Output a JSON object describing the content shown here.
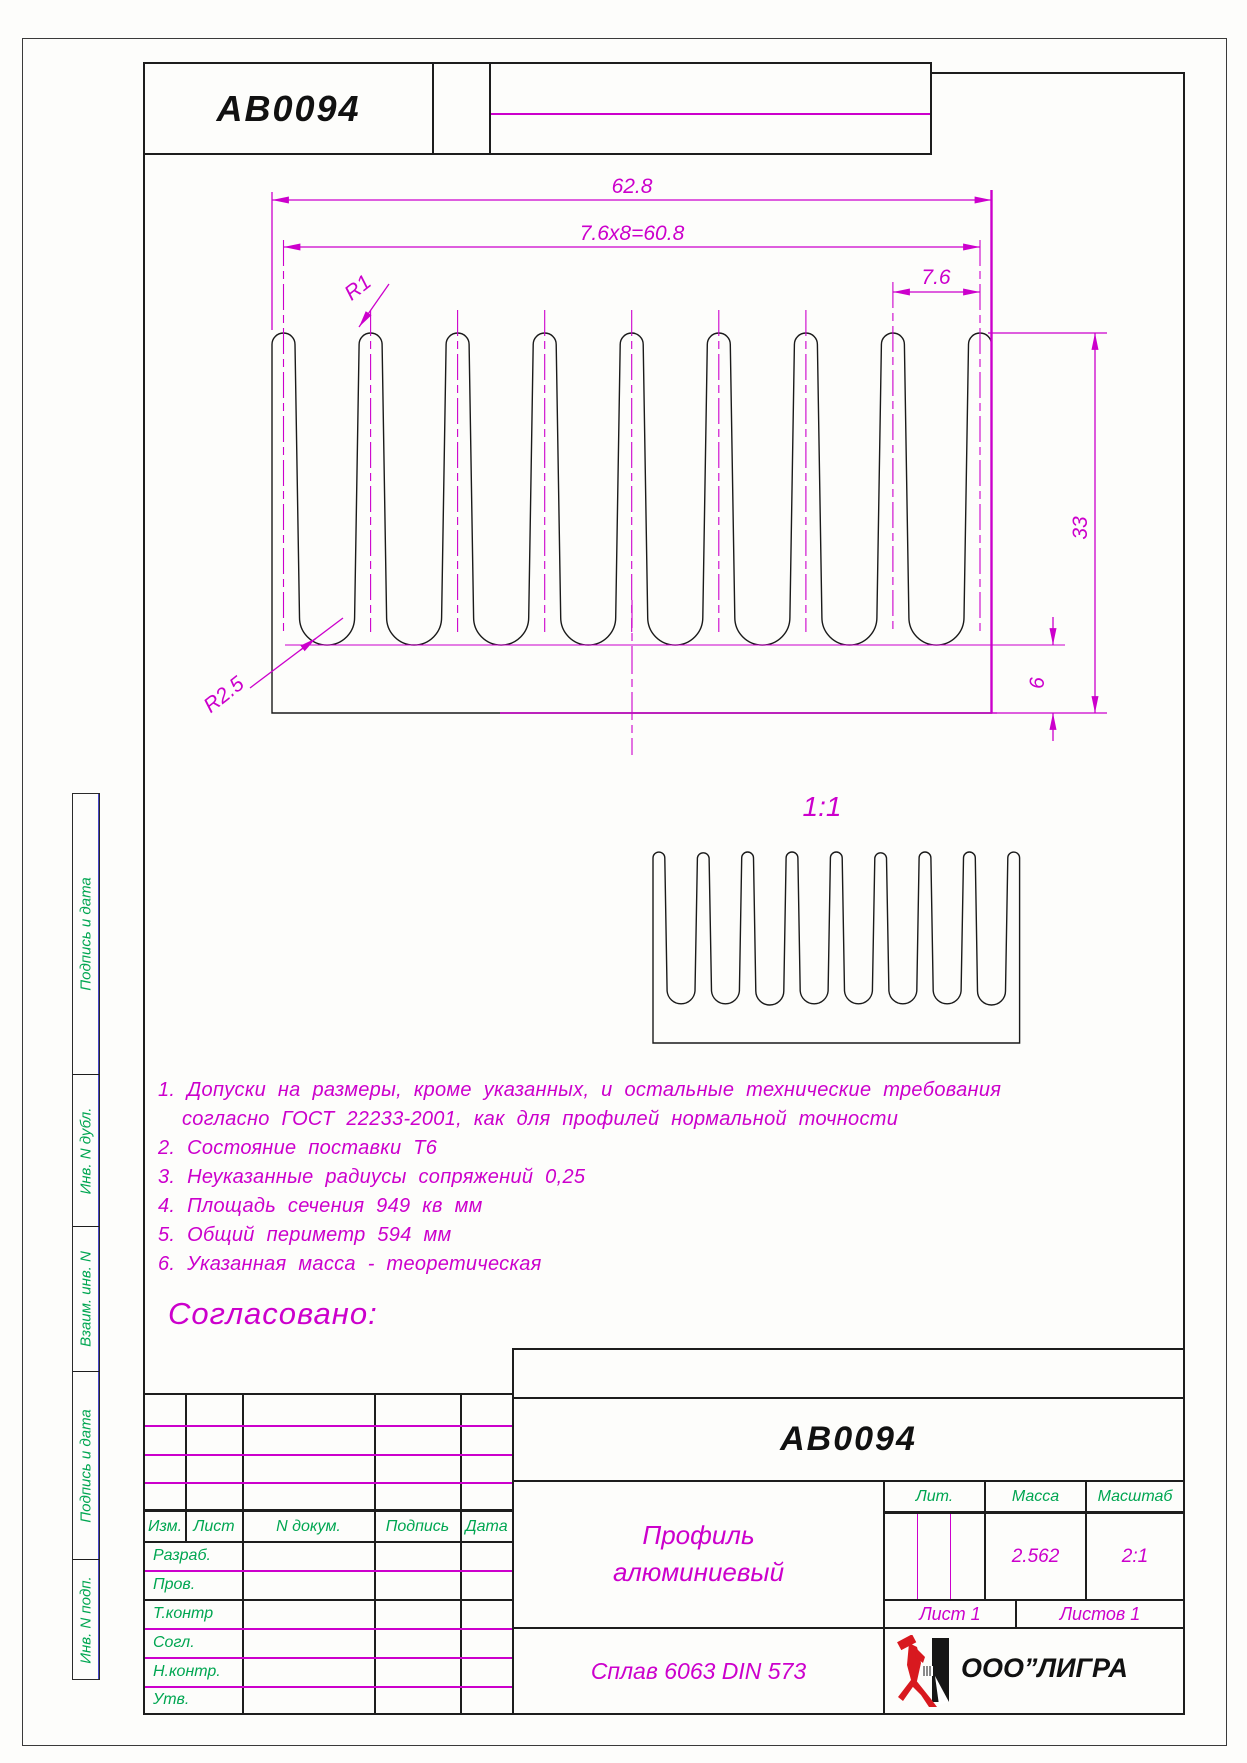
{
  "top_strip": {
    "doc_number": "AB0094"
  },
  "drawing": {
    "dim_width_total": "62.8",
    "dim_pitch_total": "7.6x8=60.8",
    "dim_pitch": "7.6",
    "dim_height_total": "33",
    "dim_base": "6",
    "radius_fin_label": "R1",
    "radius_gap_label": "R2.5",
    "scale_view_label": "1:1"
  },
  "notes": [
    "1.  Допуски  на  размеры,  кроме  указанных,  и  остальные  технические  требования",
    "согласно  ГОСТ  22233-2001,  как  для  профилей  нормальной  точности",
    "2.  Состояние  поставки  Т6",
    "3.  Неуказанные  радиусы  сопряжений  0,25",
    "4.  Площадь  сечения  949  кв  мм",
    "5.  Общий  периметр  594  мм",
    "6.  Указанная  масса  -  теоретическая"
  ],
  "approved_label": "Согласовано:",
  "title_block": {
    "doc_number": "AB0094",
    "name_line1": "Профиль",
    "name_line2": "алюминиевый",
    "material": "Сплав  6063  DIN  573",
    "company": "ООО”ЛИГРА",
    "col_izm": "Изм.",
    "col_list": "Лист",
    "col_doc": "N  докум.",
    "col_sign": "Подпись",
    "col_date": "Дата",
    "col_lit": "Лит.",
    "col_mass": "Масса",
    "col_scale": "Масштаб",
    "sign_rows": [
      "Разраб.",
      "Пров.",
      "Т.контр",
      "Согл.",
      "Н.контр.",
      "Утв."
    ],
    "mass_value": "2.562",
    "scale_value": "2:1",
    "sheet_info": "Лист  1",
    "sheets_info": "Листов  1"
  },
  "margin_labels": [
    "Подпись и дата",
    "Инв. N дубл.",
    "Взаим. инв. N",
    "Подпись и дата",
    "Инв. N подп."
  ],
  "colors": {
    "accent_magenta": "#cc00cc",
    "table_green": "#00a651",
    "logo_red": "#d8191f"
  }
}
